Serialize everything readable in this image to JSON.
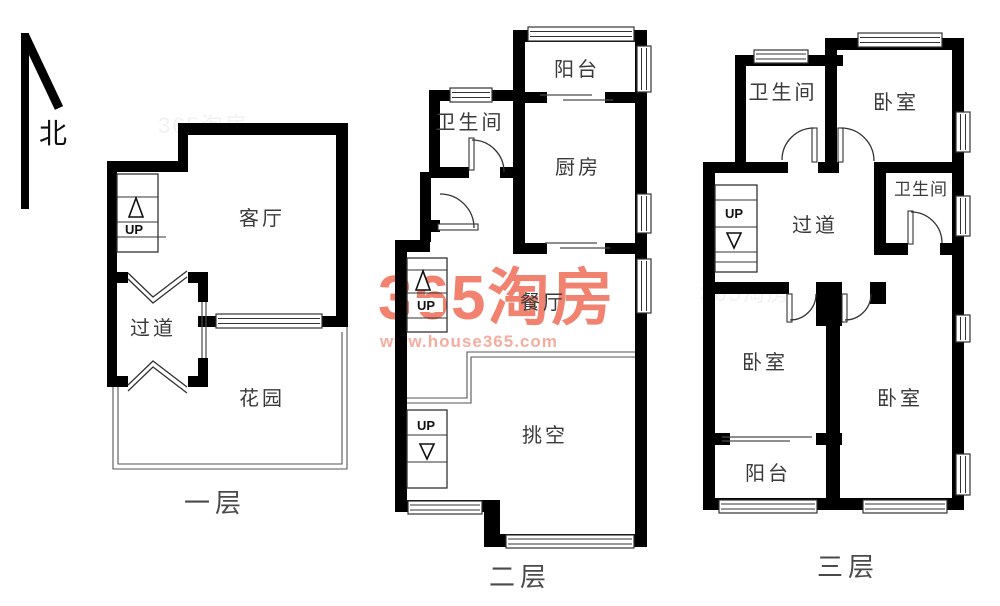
{
  "colors": {
    "wall": "#000000",
    "line": "#4a4a4a",
    "watermark_logo": "#F1826F",
    "watermark_url": "#F6AD9F"
  },
  "north_label": "北",
  "watermark": {
    "logo": "365淘房",
    "url": "www.house365.com"
  },
  "stairs_up_label": "UP",
  "floor1": {
    "label": "一层",
    "living_room": "客厅",
    "hallway": "过道",
    "garden": "花园"
  },
  "floor2": {
    "label": "二层",
    "balcony": "阳台",
    "bathroom": "卫生间",
    "kitchen": "厨房",
    "dining_room": "餐厅",
    "void_space": "挑空"
  },
  "floor3": {
    "label": "三层",
    "bathroom_top": "卫生间",
    "bedroom_top": "卧室",
    "hallway": "过道",
    "bathroom_right": "卫生间",
    "bedroom_left": "卧室",
    "bedroom_right": "卧室",
    "balcony": "阳台"
  }
}
